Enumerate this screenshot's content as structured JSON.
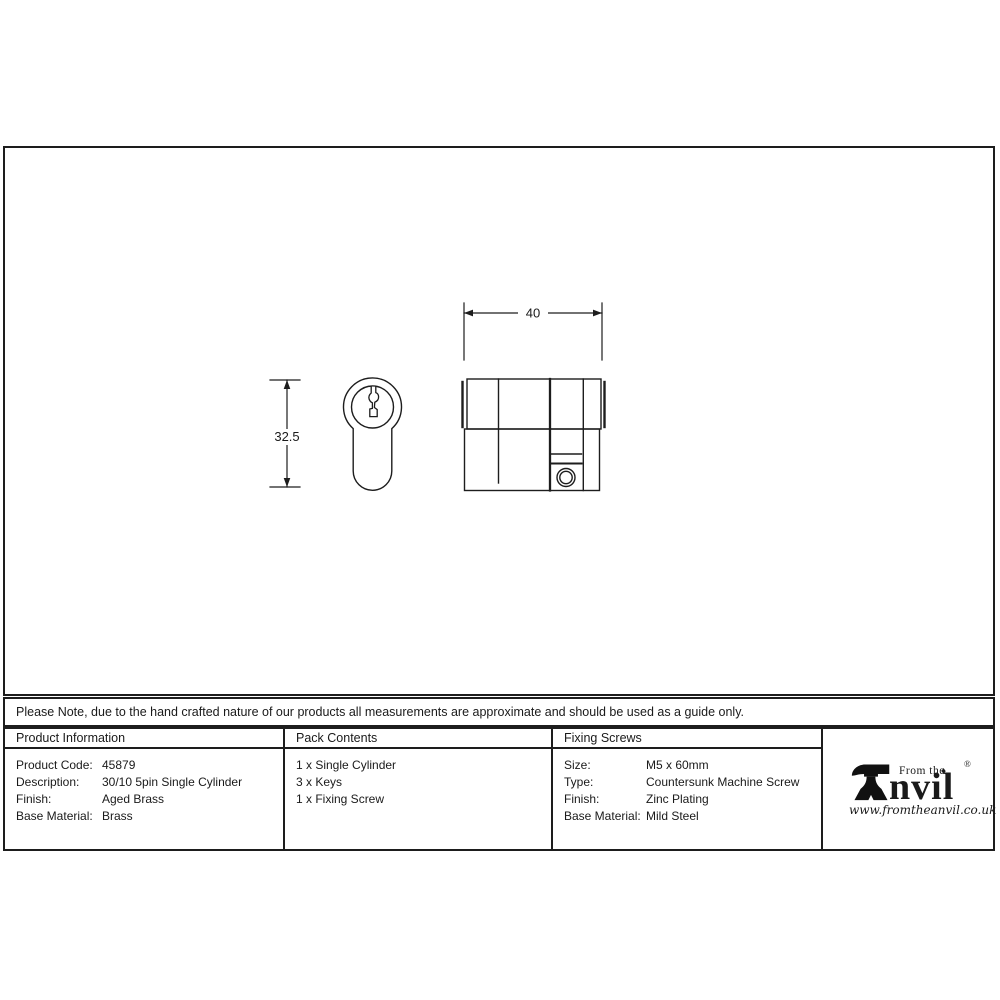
{
  "drawing": {
    "dim_width": "40",
    "dim_height": "32.5"
  },
  "note_bar": {
    "text": "Please Note, due to the hand crafted nature of our products all measurements are approximate and should be used as a guide only."
  },
  "product_info": {
    "header": "Product Information",
    "rows": [
      {
        "label": "Product Code:",
        "value": "45879"
      },
      {
        "label": "Description:",
        "value": "30/10 5pin Single Cylinder"
      },
      {
        "label": "Finish:",
        "value": "Aged Brass"
      },
      {
        "label": "Base Material:",
        "value": "Brass"
      }
    ]
  },
  "pack_contents": {
    "header": "Pack Contents",
    "items": [
      "1 x Single Cylinder",
      "3 x Keys",
      "1 x Fixing Screw"
    ]
  },
  "fixing_screws": {
    "header": "Fixing Screws",
    "rows": [
      {
        "label": "Size:",
        "value": "M5 x 60mm"
      },
      {
        "label": "Type:",
        "value": "Countersunk Machine Screw"
      },
      {
        "label": "Finish:",
        "value": "Zinc Plating"
      },
      {
        "label": "Base Material:",
        "value": "Mild Steel"
      }
    ]
  },
  "logo": {
    "prefix": "From the",
    "brand_tail": "nvil",
    "diamond": "♦",
    "registered": "®",
    "website": "www.fromtheanvil.co.uk"
  },
  "colors": {
    "ink": "#1a1a1a",
    "background": "#ffffff"
  }
}
